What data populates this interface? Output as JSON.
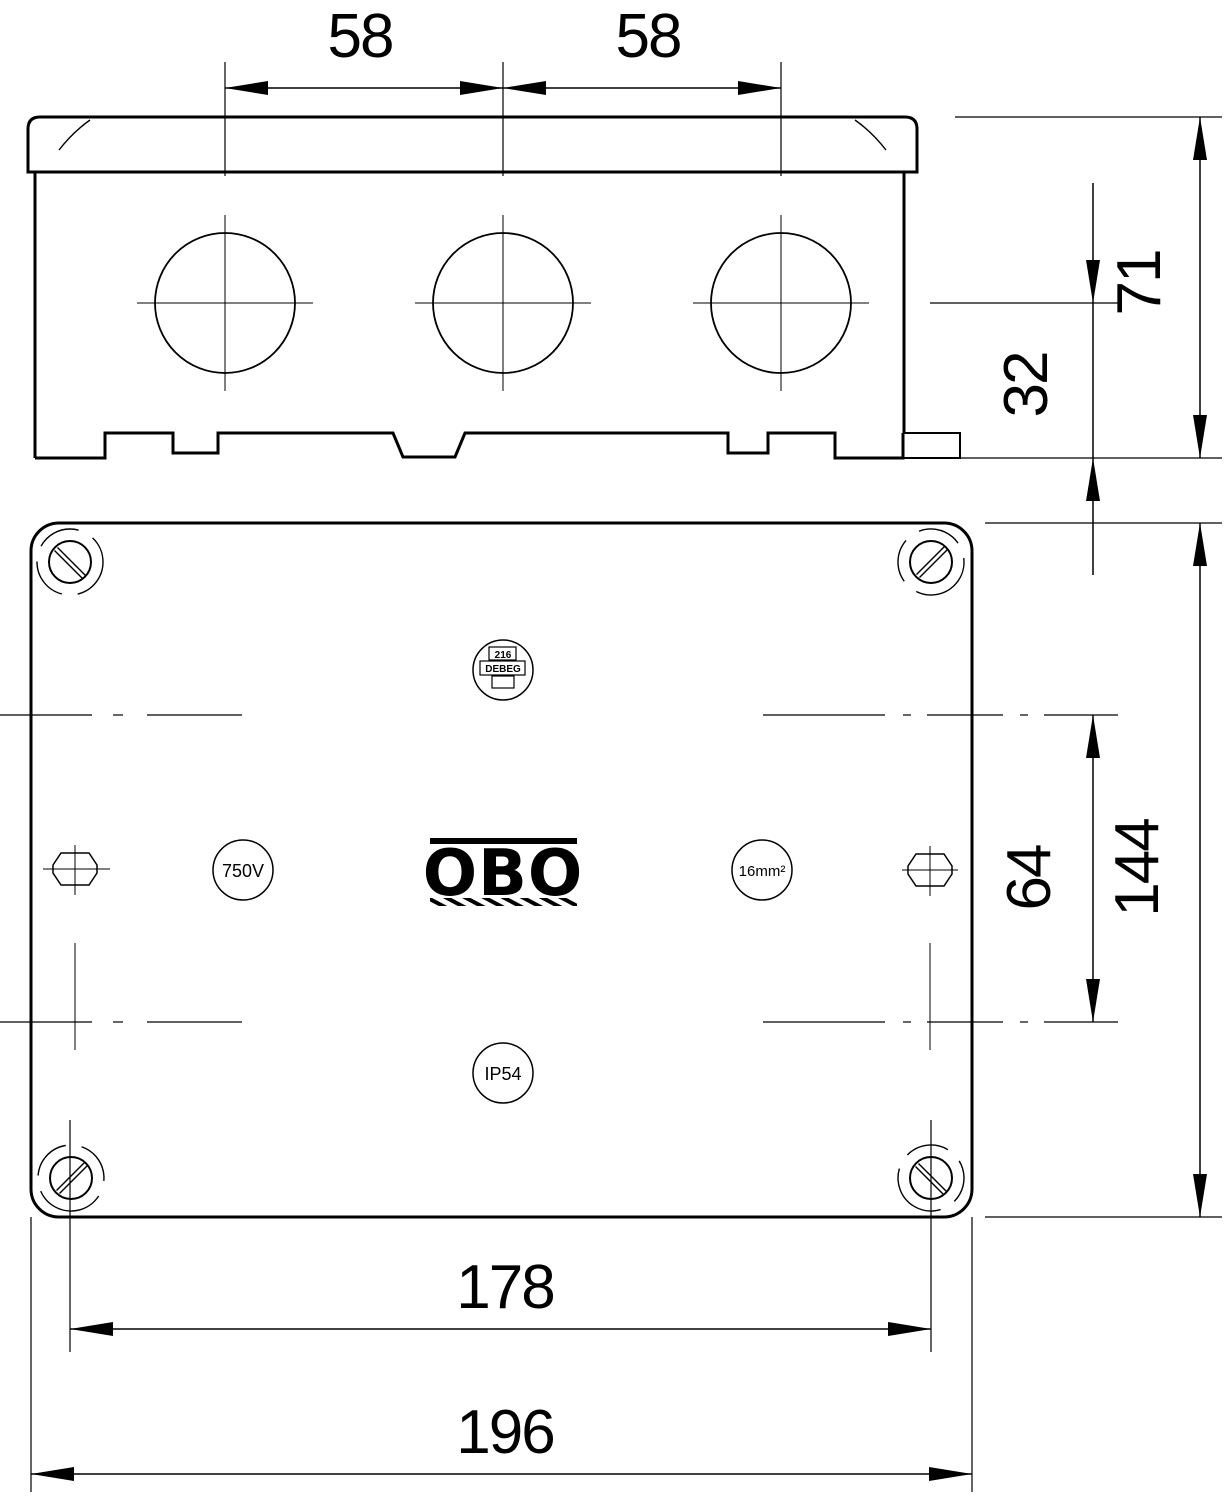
{
  "dimensions": {
    "knockout_spacing_left": "58",
    "knockout_spacing_right": "58",
    "box_height": "71",
    "knockout_center_to_base": "32",
    "lid_length": "144",
    "centerline_spacing": "64",
    "screw_spacing": "178",
    "lid_width": "196"
  },
  "markings": {
    "brand": "OBO",
    "stamp_number": "216",
    "stamp_name": "DEBEG",
    "voltage_rating": "750V",
    "conductor_size": "16mm²",
    "protection_rating": "IP54"
  },
  "colors": {
    "line": "#000000",
    "background": "#ffffff"
  }
}
